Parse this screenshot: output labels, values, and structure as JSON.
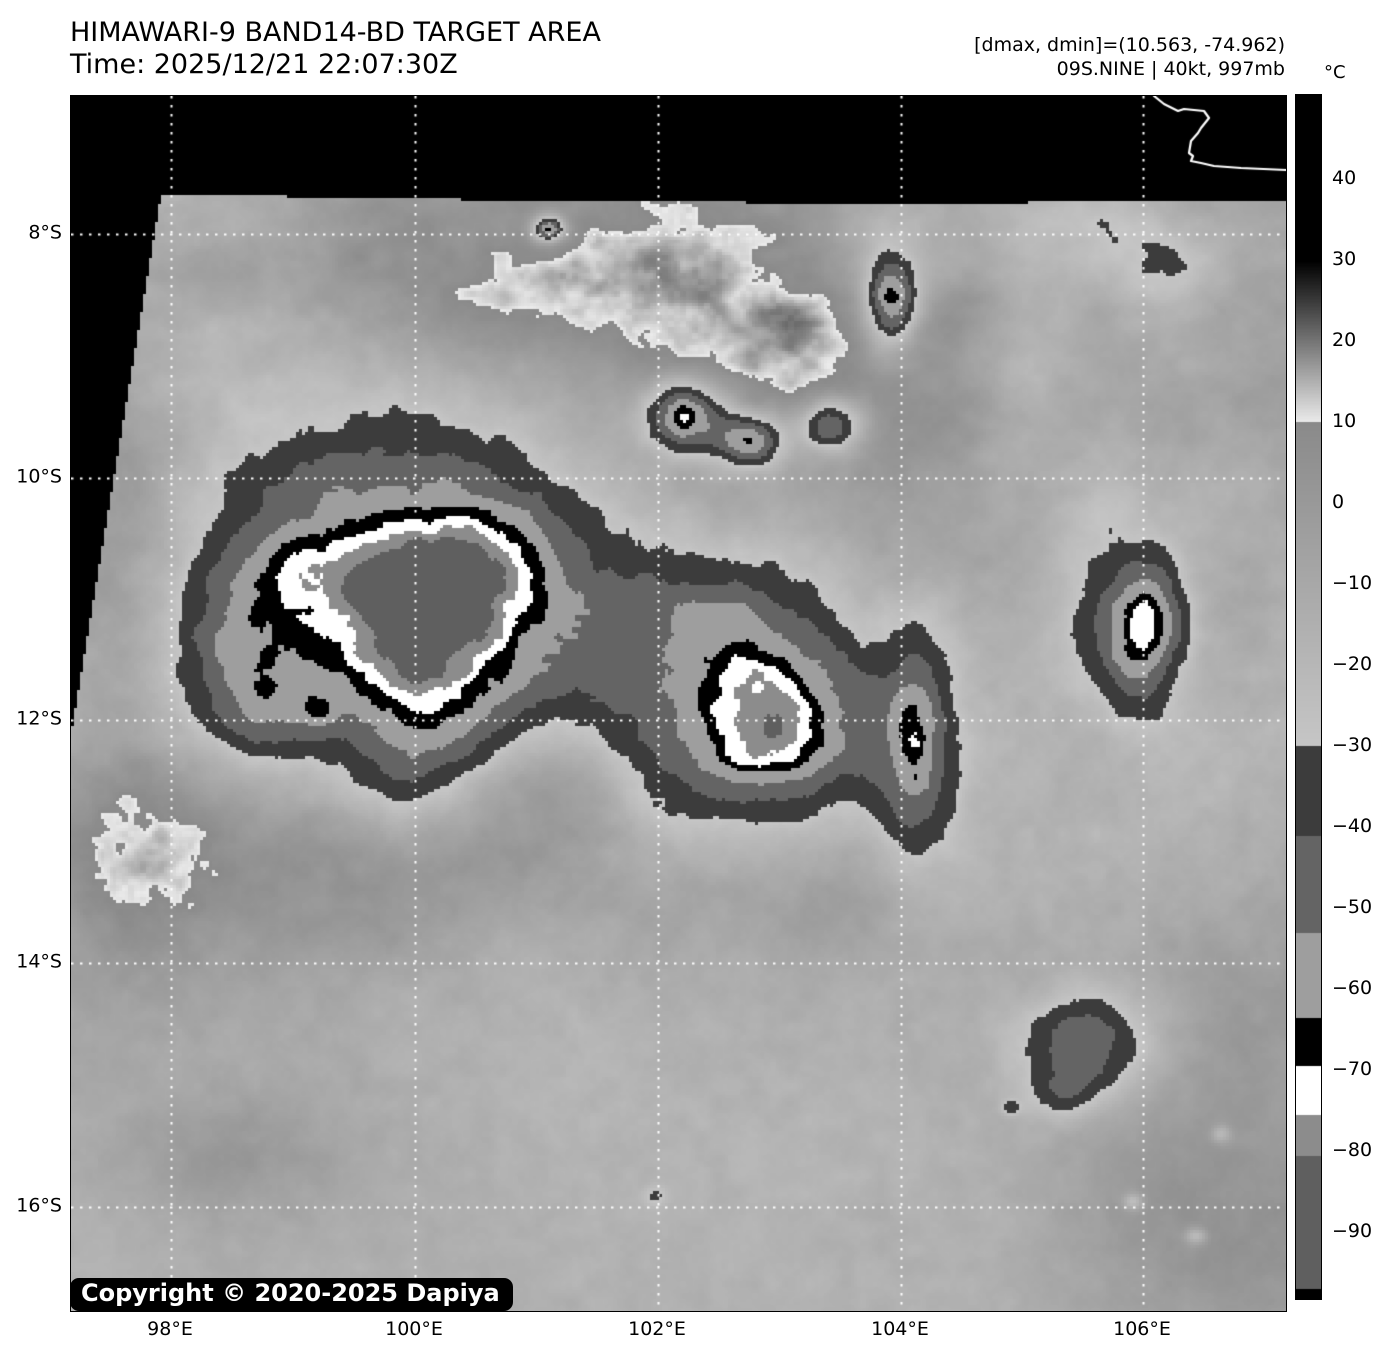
{
  "header": {
    "title": "HIMAWARI-9 BAND14-BD TARGET AREA",
    "time": "Time: 2025/12/21 22:07:30Z",
    "stats": "[dmax, dmin]=(10.563, -74.962)",
    "storm": "09S.NINE | 40kt, 997mb"
  },
  "colorbar": {
    "unit": "°C",
    "ticks": [
      "40",
      "30",
      "20",
      "10",
      "0",
      "−10",
      "−20",
      "−30",
      "−40",
      "−50",
      "−60",
      "−70",
      "−80",
      "−90"
    ]
  },
  "axes": {
    "lat": [
      "8°S",
      "10°S",
      "12°S",
      "14°S",
      "16°S"
    ],
    "lon": [
      "98°E",
      "100°E",
      "102°E",
      "104°E",
      "106°E"
    ]
  },
  "copyright": "Copyright © 2020-2025 Dapiya",
  "palette": {
    "no_data": "#000000",
    "gridlines": "#ffffff",
    "coastline": "#ffffff",
    "text": "#000000",
    "badge_bg": "#000000",
    "badge_fg": "#ffffff",
    "bd_bands": [
      {
        "from": 60,
        "to": 30,
        "type": "solid",
        "gray": 0
      },
      {
        "from": 30,
        "to": 10,
        "type": "gradient",
        "gray_start": 0,
        "gray_end": 235
      },
      {
        "from": 10,
        "to": -30,
        "type": "gradient",
        "gray_start": 138,
        "gray_end": 198
      },
      {
        "from": -30,
        "to": -41,
        "type": "solid",
        "gray": 60
      },
      {
        "from": -41,
        "to": -53,
        "type": "solid",
        "gray": 100
      },
      {
        "from": -53,
        "to": -63.5,
        "type": "solid",
        "gray": 158
      },
      {
        "from": -63.5,
        "to": -69.5,
        "type": "solid",
        "gray": 0
      },
      {
        "from": -69.5,
        "to": -75.5,
        "type": "solid",
        "gray": 255
      },
      {
        "from": -75.5,
        "to": -80.5,
        "type": "solid",
        "gray": 140
      },
      {
        "from": -80.5,
        "to": -97,
        "type": "solid",
        "gray": 95
      },
      {
        "from": -97,
        "to": -110,
        "type": "solid",
        "gray": 0
      }
    ]
  }
}
